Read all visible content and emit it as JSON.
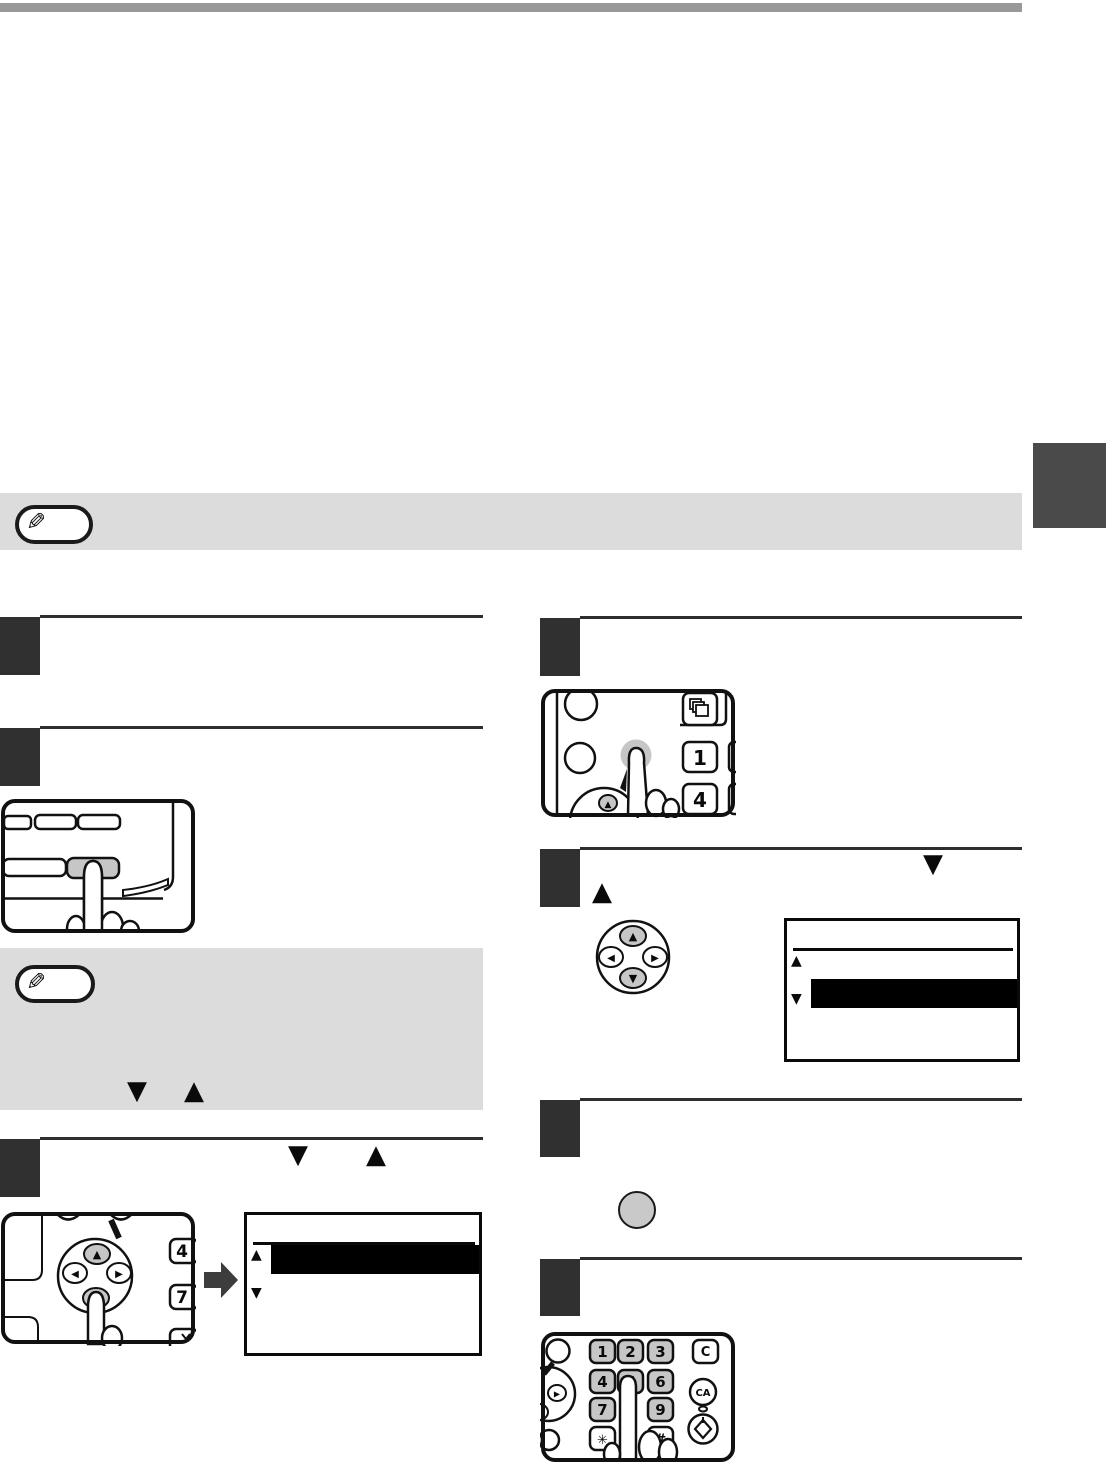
{
  "page": {
    "type": "copier-manual-instruction-page"
  },
  "colors": {
    "top_bar": "#999999",
    "side_tab": "#4a4a4a",
    "note_background": "#dcdcdc",
    "step_box": "#303030",
    "key_gray": "#c6c6c6",
    "highlight_bar": "#000000"
  },
  "glyphs": {
    "pencil": "✎",
    "up": "▲",
    "down": "▼",
    "left": "◀",
    "right": "▶"
  },
  "left_column": {
    "note_symbols": {
      "down": "▼",
      "up": "▲"
    },
    "step3_symbols": {
      "down": "▼",
      "up": "▲"
    },
    "pad_panel": {
      "key_4": "4",
      "key_7": "7",
      "pad_up": "▲",
      "pad_down": "▼",
      "pad_left": "◀",
      "pad_right": "▶"
    },
    "display": {
      "scroll_up": "▲",
      "scroll_down": "▼"
    }
  },
  "right_column": {
    "step2_symbols": {
      "down": "▼",
      "up": "▲"
    },
    "panel": {
      "key_1": "1",
      "key_4": "4",
      "pad_up": "▲"
    },
    "pad": {
      "up": "▲",
      "down": "▼",
      "left": "◀",
      "right": "▶"
    },
    "display": {
      "scroll_up": "▲",
      "scroll_down": "▼"
    },
    "keypad": {
      "key_1": "1",
      "key_2": "2",
      "key_3": "3",
      "key_4": "4",
      "key_5": "5",
      "key_6": "6",
      "key_7": "7",
      "key_9": "9",
      "star": "✳",
      "hash": "#",
      "clear": "C",
      "clear_all": "CA",
      "pad_right": "▶"
    }
  }
}
